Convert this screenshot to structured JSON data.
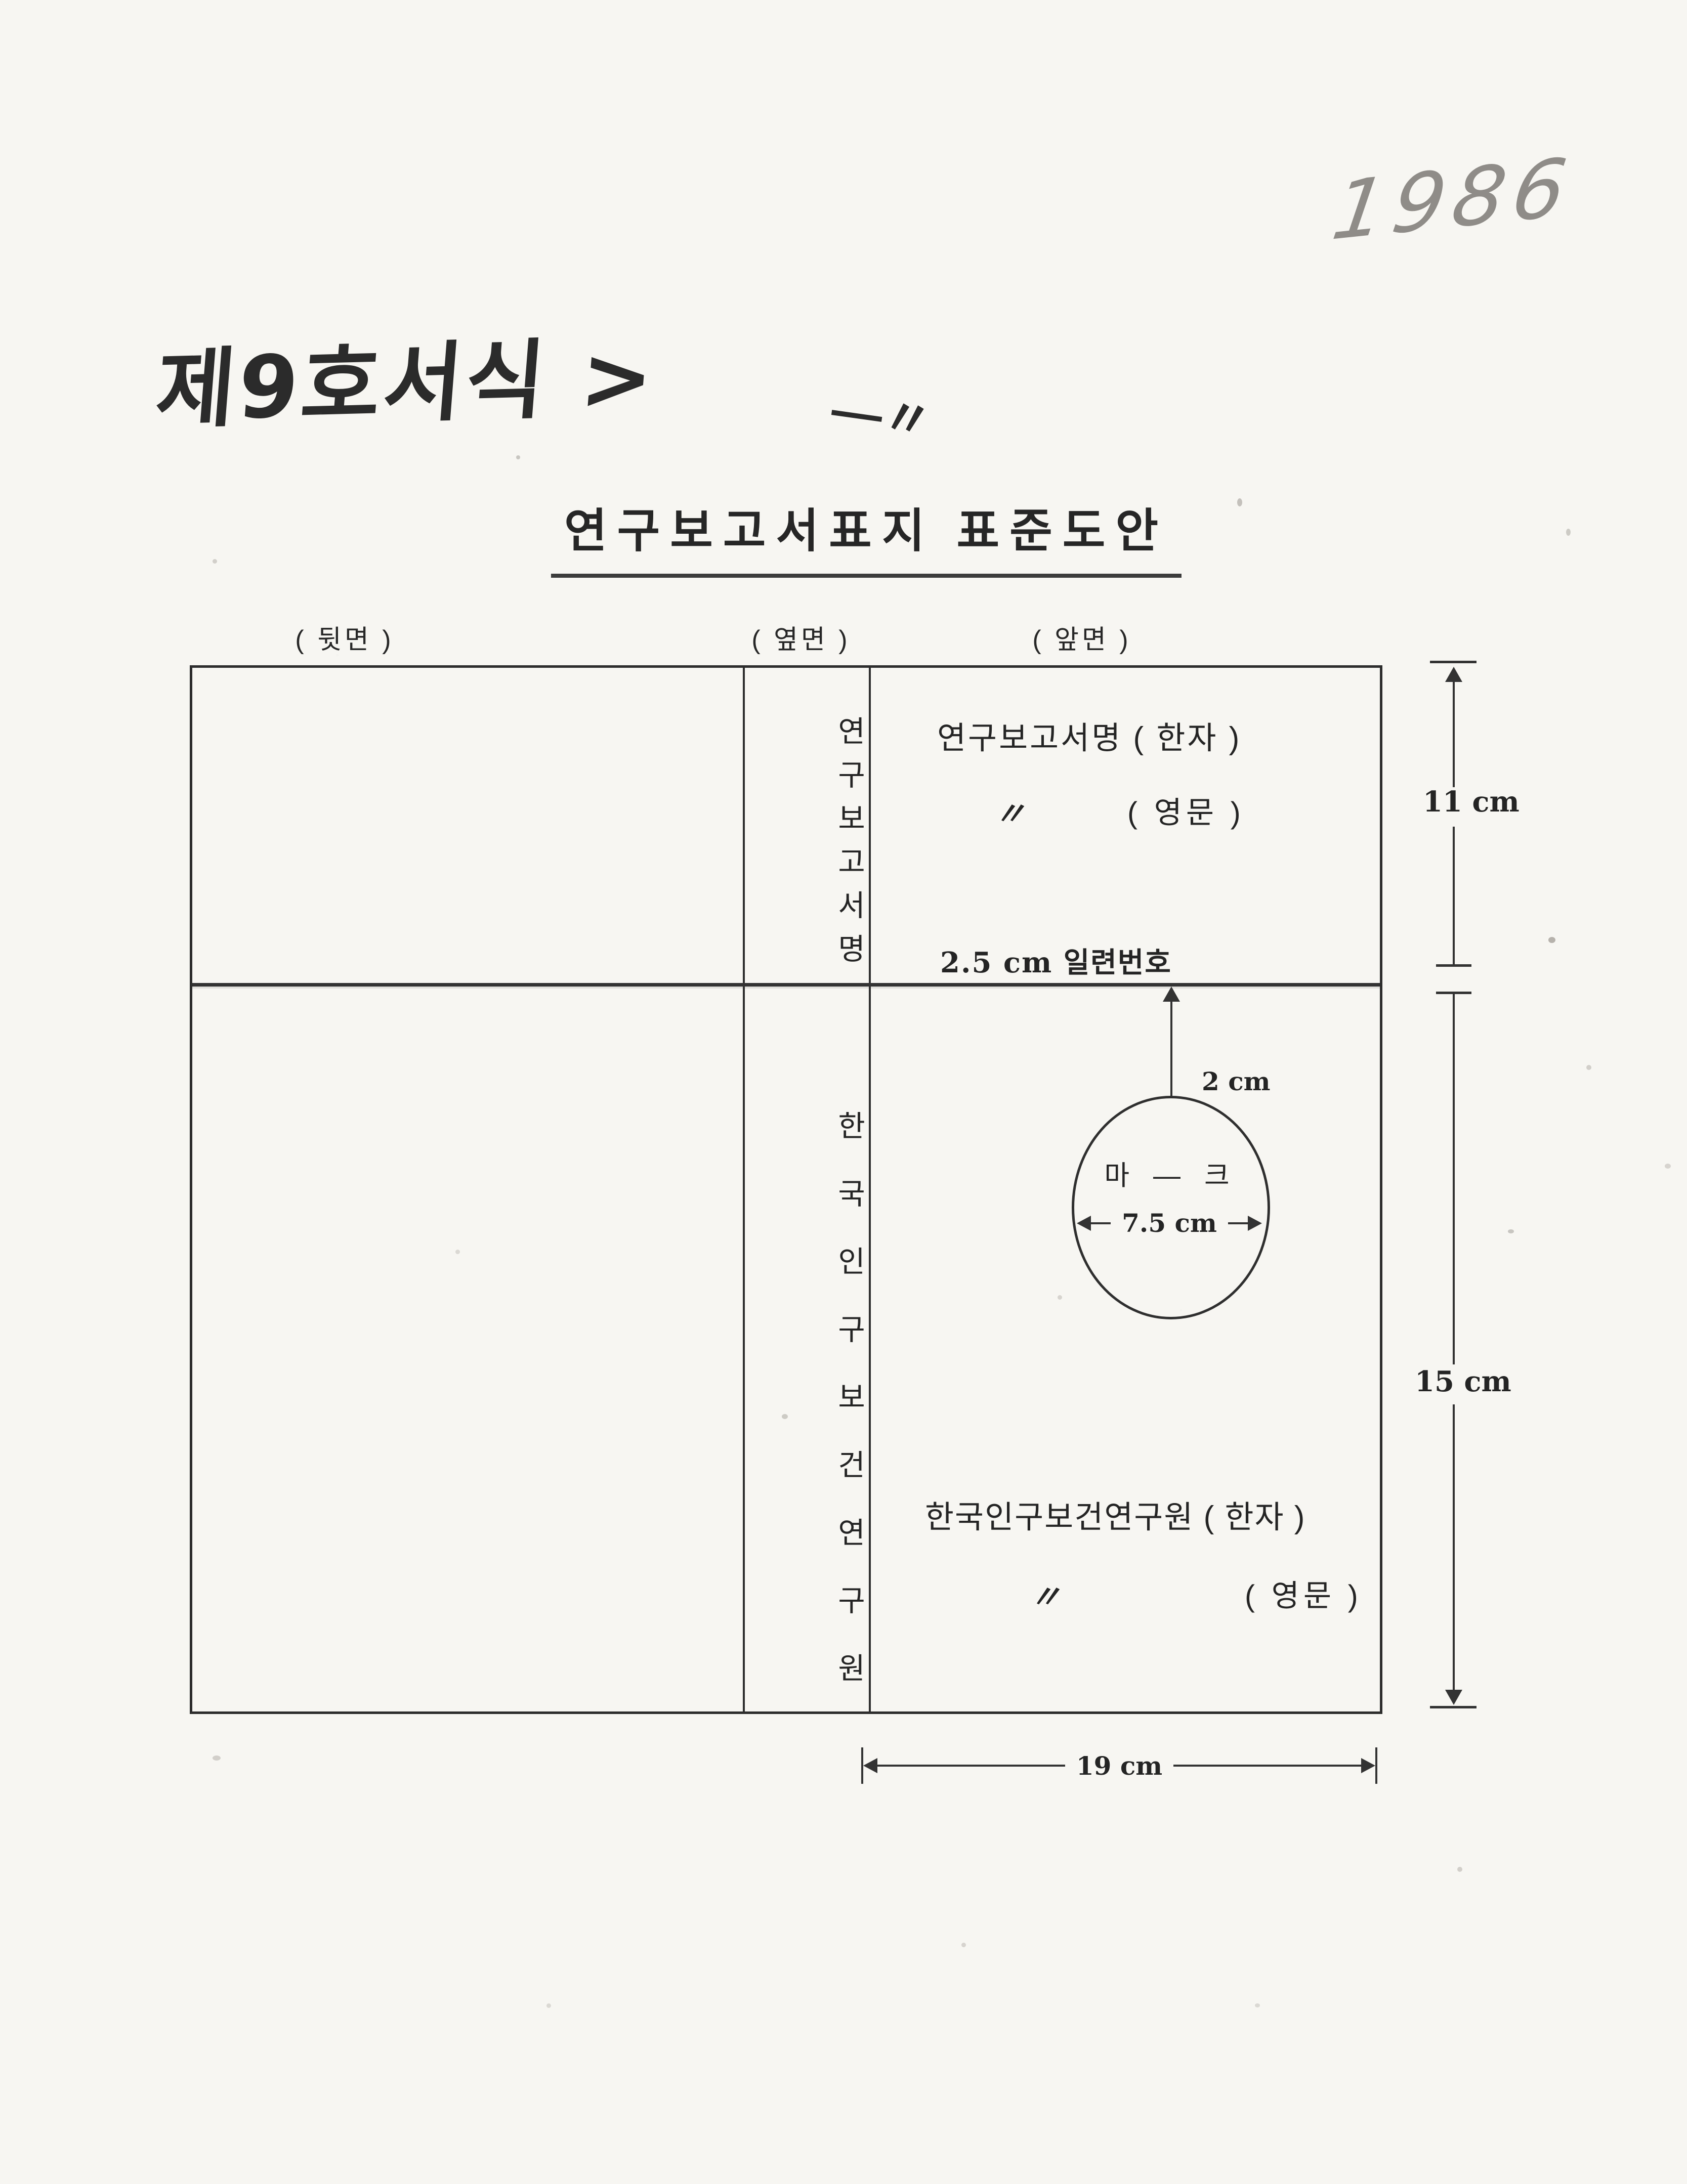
{
  "colors": {
    "paper": "#f7f6f2",
    "ink": "#2e2e2e",
    "pencil_gray": "#8f8c88"
  },
  "annotations": {
    "year": "1986",
    "form_number": "제9호서식 >",
    "stray_mark": "―〃"
  },
  "title": "연구보고서표지 표준도안",
  "panel_labels": {
    "back": "( 뒷면 )",
    "side": "( 옆면 )",
    "front": "( 앞면 )"
  },
  "spine": {
    "top_text": "연구보고서명",
    "bottom_text": "한국인구보건연구원"
  },
  "front_panel": {
    "report_title_hanja": "연구보고서명 ( 한자 )",
    "report_title_ditto": "〃",
    "report_title_english": "( 영문 )",
    "serial_note": "2.5 cm   일련번호",
    "mark_offset": "2 cm",
    "mark_label": "마 ― 크",
    "mark_diameter": "7.5 cm",
    "institute_hanja": "한국인구보건연구원 ( 한자 )",
    "institute_ditto": "〃",
    "institute_english": "( 영문 )"
  },
  "dimensions": {
    "top_height": "11 cm",
    "bottom_height": "15 cm",
    "width": "19 cm"
  }
}
